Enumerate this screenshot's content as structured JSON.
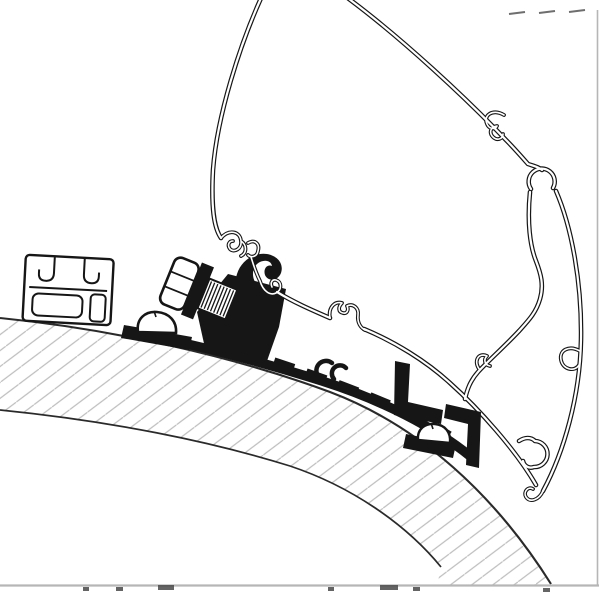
{
  "figure": {
    "kind": "technical-line-drawing",
    "parts": [
      "awning-case-profile",
      "roof-cross-section-hatched",
      "wall-mount-rail-profile",
      "adapter-rail-profile",
      "hex-bolt-with-washer",
      "screw-dome-front",
      "screw-dome-rear",
      "adapter-end-bracket"
    ]
  },
  "colors": {
    "paper": "#ffffff",
    "ink": "#161616",
    "outline": "#2a2a2a",
    "hatch": "#bdbdbd",
    "border": "#b6b6b6",
    "artifact": "#4a4a4a"
  }
}
